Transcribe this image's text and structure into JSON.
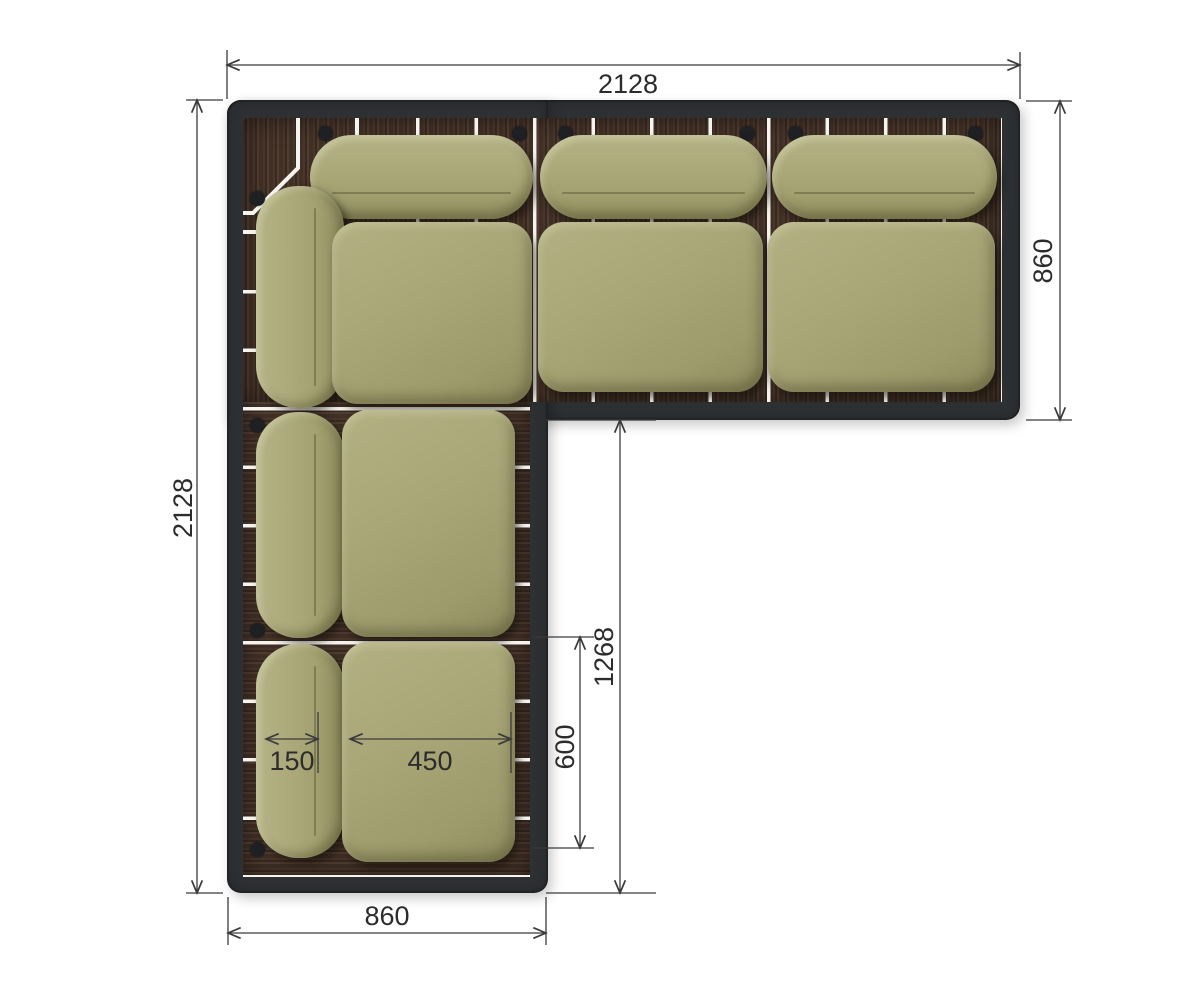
{
  "drawing": {
    "type": "furniture-plan-top-view",
    "subject": "L-shaped corner sofa on slatted wood platform"
  },
  "dimensions": {
    "overall_width_top": "2128",
    "right_section_depth": "860",
    "overall_depth_left": "2128",
    "chaise_inner_length": "1268",
    "seat_module_length": "600",
    "seat_cushion_width": "450",
    "back_cushion_width": "150",
    "bottom_section_width": "860"
  },
  "colors": {
    "frame": "#2e3134",
    "wood": "#433228",
    "slat_gap": "#f5f4ee",
    "cushion": "#a9a678",
    "dimension_line": "#3b3b3b",
    "background": "#ffffff"
  }
}
